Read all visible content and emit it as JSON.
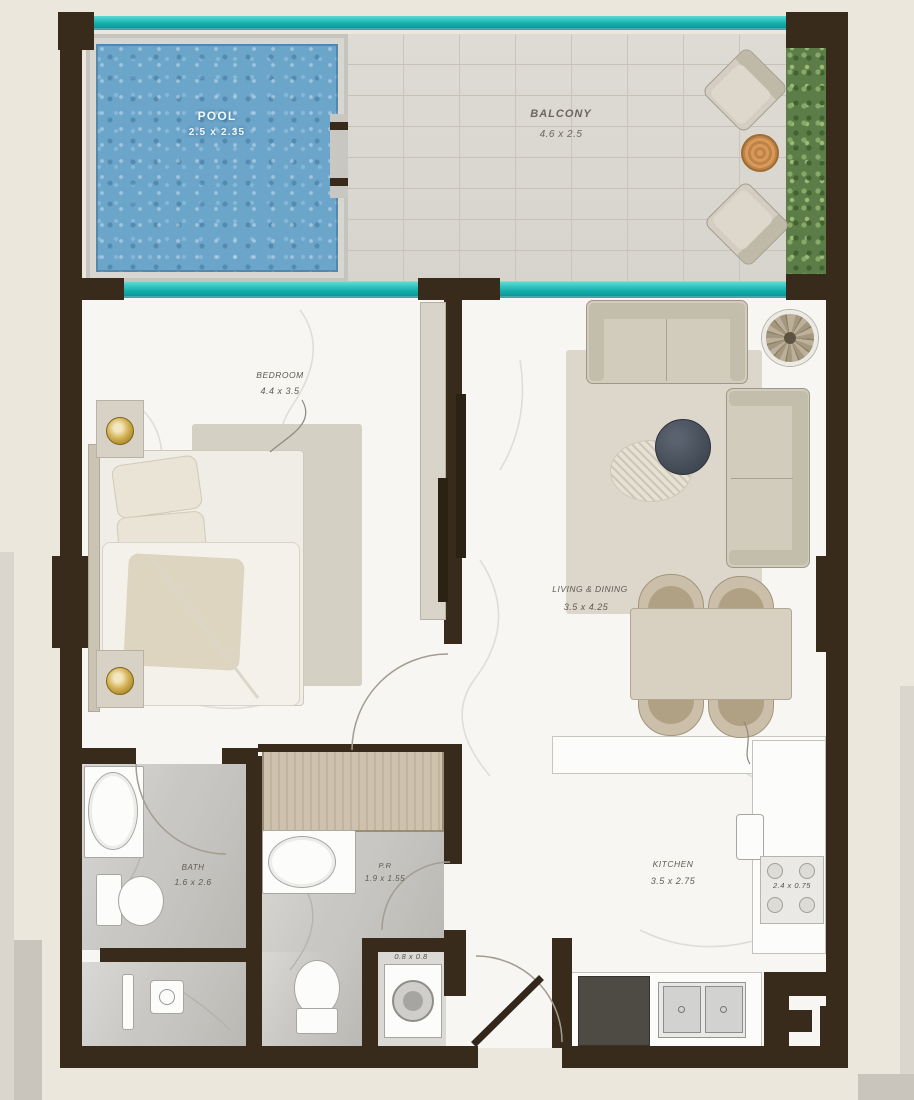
{
  "floorplan": {
    "rooms": {
      "pool": {
        "label": "POOL",
        "dims": "2.5 x 2.35"
      },
      "balcony": {
        "label": "BALCONY",
        "dims": "4.6 x 2.5"
      },
      "bedroom": {
        "label": "BEDROOM",
        "dims": "4.4 x 3.5"
      },
      "living_dining": {
        "label": "LIVING & DINING",
        "dims": "3.5 x 4.25"
      },
      "bath": {
        "label": "BATH",
        "dims": "1.6 x 2.6"
      },
      "powder_room": {
        "label": "P.R",
        "dims": "1.9 x 1.55"
      },
      "kitchen": {
        "label": "KITCHEN",
        "dims": "3.5 x 2.75"
      },
      "kitchen_counter": {
        "dims": "2.4 x 0.75"
      },
      "laundry": {
        "dims": "0.8 x 0.8"
      }
    },
    "colors": {
      "wall": "#392b1b",
      "glass_teal": "#12ada9",
      "pool_water": "#6ba5ca",
      "background": "#ebe7dd"
    }
  }
}
